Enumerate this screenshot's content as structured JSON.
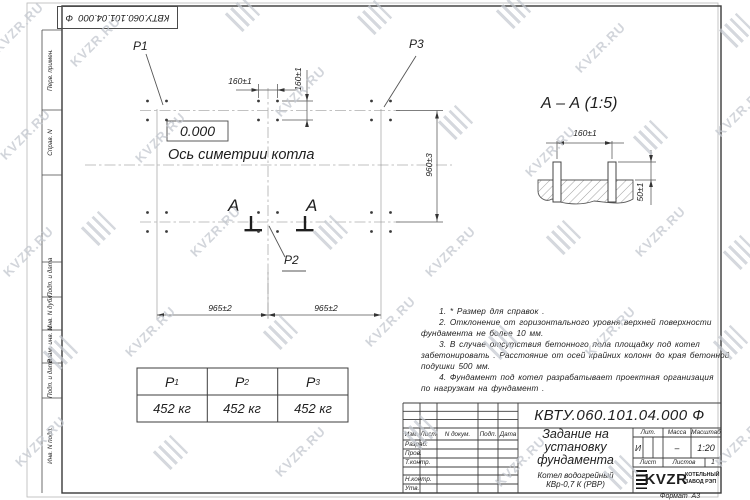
{
  "watermark": {
    "text": "KVZR.RU"
  },
  "sheet": {
    "top_designation": "КВТУ.060.101.04.000  Ф",
    "format_note": "Формат  А3"
  },
  "left_strip": {
    "items": [
      {
        "label": "Перв. примен."
      },
      {
        "label": "Справ. N"
      },
      {
        "label": "Подп. и дата"
      },
      {
        "label": "Инв. N дубл."
      },
      {
        "label": "Взам. инв. N"
      },
      {
        "label": "Подп. и дата"
      },
      {
        "label": "Инв. N подл."
      }
    ]
  },
  "plan": {
    "labels": {
      "p1": "P1",
      "p2": "P2",
      "p3": "P3",
      "section_letter_left": "A",
      "section_letter_right": "A"
    },
    "elevation": "0.000",
    "axis_label": "Ось симетрии котла",
    "dims": {
      "bolt_spacing_h": "160±1",
      "bolt_spacing_v": "160±1",
      "row_spacing": "960±3",
      "span_left": "965±2",
      "span_right": "965±2"
    }
  },
  "section_view": {
    "title": "А – А (1:5)",
    "dims": {
      "bolt_spacing": "160±1",
      "protrusion": "50±1"
    }
  },
  "notes": {
    "lines": [
      "     1. * Размер для справок .",
      "     2. Отклонение от горизонтального уровня верхней поверхности",
      "фундамента не более 10 мм.",
      "     3. В случае отсутствия бетонного пола площадку под котел",
      "забетонировать . Расстояние от осей крайних колонн до края бетонной",
      "подушки 500 мм.",
      "     4. Фундамент под котел разрабатывает проектная организация",
      "по нагрузкам на фундамент ."
    ]
  },
  "load_table": {
    "headers": [
      {
        "name": "P",
        "sub": "1"
      },
      {
        "name": "P",
        "sub": "2"
      },
      {
        "name": "P",
        "sub": "3"
      }
    ],
    "values": [
      "452 кг",
      "452 кг",
      "452 кг"
    ]
  },
  "title_block": {
    "designation": "КВТУ.060.101.04.000  Ф",
    "document_title": "Задание на\nустановку\nфундамента",
    "product": "Котел водогрейный\nКВр-0,7 К (РВР)",
    "header_cols": {
      "izm": "Изм.",
      "list": "Лист",
      "n_doc": "N докум.",
      "podp": "Подп.",
      "data": "Дата"
    },
    "signature_rows": [
      {
        "label": "Разраб."
      },
      {
        "label": "Пров."
      },
      {
        "label": "Т.контр."
      },
      {
        "label": "Н.контр."
      },
      {
        "label": "Утв."
      }
    ],
    "lit": {
      "label": "Лит.",
      "value": "И"
    },
    "massa": {
      "label": "Масса",
      "value": "–"
    },
    "masshtab": {
      "label": "Масштаб",
      "value": "1:20"
    },
    "sheet_no": {
      "label": "Лист",
      "value": ""
    },
    "sheets_total": {
      "label": "Листов",
      "value": "1"
    },
    "logo": {
      "text": "KVZR",
      "company_line1": "КОТЕЛЬНЫЙ",
      "company_line2": "ЗАВОД РЭП"
    }
  }
}
